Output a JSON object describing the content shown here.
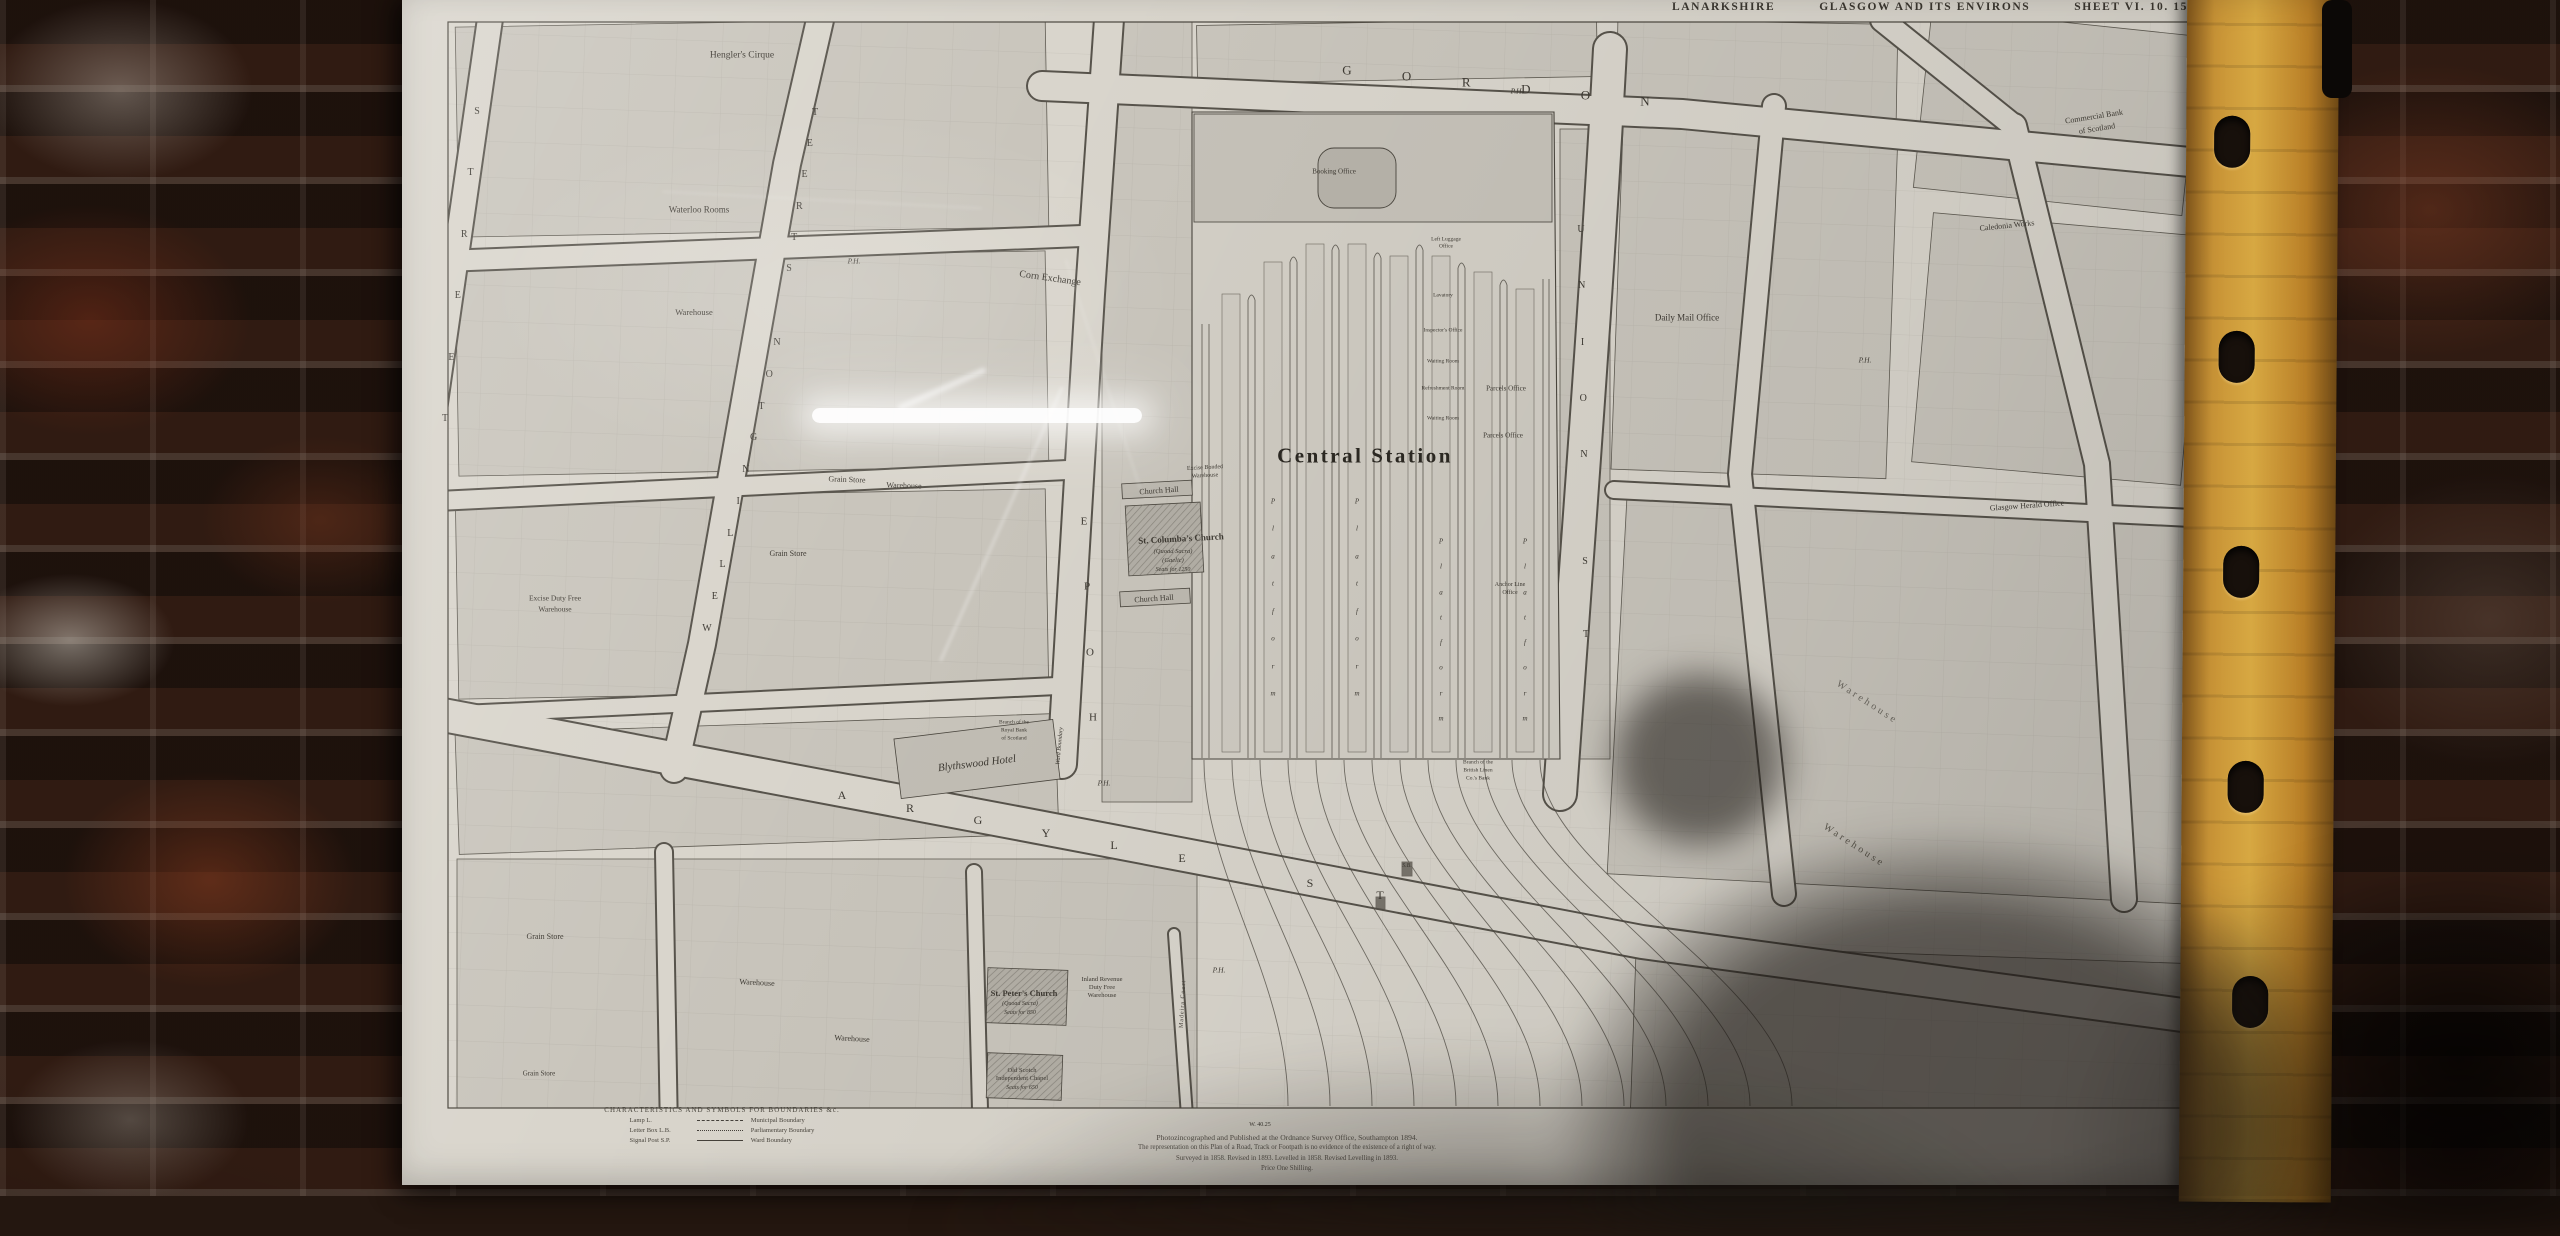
{
  "photo": {
    "colors": {
      "brick_dark": "#2a1911",
      "brick_red": "#7c3f27",
      "mortar": "#b9a99c",
      "binder_strip": "#c08a2e",
      "paper": "#d9d5cc",
      "ink": "#3e3a33"
    },
    "binder_holes": 5
  },
  "map": {
    "header": {
      "county": "LANARKSHIRE",
      "title": "GLASGOW AND ITS ENVIRONS",
      "sheet": "SHEET VI. 10. 15"
    },
    "station_title": "Central Station",
    "labels": [
      {
        "t": "Central Station",
        "x": 963,
        "y": 462,
        "s": 21,
        "b": 1,
        "ls": 2.5,
        "c": "#2c2923"
      },
      {
        "t": "Hengler's Cirque",
        "x": 340,
        "y": 62,
        "s": 9.5
      },
      {
        "t": "Waterloo Rooms",
        "x": 297,
        "y": 216,
        "s": 9
      },
      {
        "t": "Warehouse",
        "x": 292,
        "y": 318,
        "s": 8.5
      },
      {
        "t": "Corn Exchange",
        "x": 648,
        "y": 285,
        "s": 10,
        "r": 8
      },
      {
        "t": "P.H.",
        "x": 452,
        "y": 267,
        "s": 7.5,
        "i": 1
      },
      {
        "t": "P.H.",
        "x": 1115,
        "y": 97,
        "s": 7.5,
        "i": 1
      },
      {
        "t": "P.H.",
        "x": 1463,
        "y": 366,
        "s": 7.5,
        "i": 1
      },
      {
        "t": "P.H.",
        "x": 702,
        "y": 789,
        "s": 7.5,
        "i": 1
      },
      {
        "t": "P.H.",
        "x": 817,
        "y": 976,
        "s": 7.5,
        "i": 1
      },
      {
        "t": "Grain Store",
        "x": 445,
        "y": 486,
        "s": 8,
        "r": 2
      },
      {
        "t": "Warehouse",
        "x": 502,
        "y": 492,
        "s": 8,
        "r": 2
      },
      {
        "t": "Grain Store",
        "x": 386,
        "y": 560,
        "s": 8
      },
      {
        "t": "Excise Duty Free",
        "x": 153,
        "y": 604,
        "s": 7.5
      },
      {
        "t": "Warehouse",
        "x": 153,
        "y": 615,
        "s": 7.5
      },
      {
        "t": "Church Hall",
        "x": 757,
        "y": 497,
        "s": 8,
        "r": -4
      },
      {
        "t": "St. Columba's Church",
        "x": 779,
        "y": 545,
        "s": 9,
        "r": -3,
        "b": 1
      },
      {
        "t": "(Quoad Sacra)",
        "x": 771,
        "y": 558,
        "s": 6.5,
        "i": 1
      },
      {
        "t": "(Gaelic)",
        "x": 771,
        "y": 567,
        "s": 6.5,
        "i": 1
      },
      {
        "t": "Seats for 1250",
        "x": 771,
        "y": 576,
        "s": 6,
        "i": 1
      },
      {
        "t": "Church Hall",
        "x": 752,
        "y": 605,
        "s": 8,
        "r": -4
      },
      {
        "t": "Excise Bonded",
        "x": 803,
        "y": 474,
        "s": 6,
        "r": -3
      },
      {
        "t": "Warehouse",
        "x": 803,
        "y": 482,
        "s": 6,
        "r": -3
      },
      {
        "t": "Blythswood Hotel",
        "x": 575,
        "y": 770,
        "s": 11,
        "i": 1,
        "r": -7
      },
      {
        "t": "Branch of the",
        "x": 612,
        "y": 729,
        "s": 5.5
      },
      {
        "t": "Royal Bank",
        "x": 612,
        "y": 737,
        "s": 5.5
      },
      {
        "t": "of Scotland",
        "x": 612,
        "y": 745,
        "s": 5.5
      },
      {
        "t": "Ward Boundary",
        "x": 658,
        "y": 752,
        "s": 6,
        "i": 1,
        "r": -85
      },
      {
        "t": "Booking Office",
        "x": 932,
        "y": 178,
        "s": 7
      },
      {
        "t": "Left Luggage",
        "x": 1044,
        "y": 246,
        "s": 5.5
      },
      {
        "t": "Office",
        "x": 1044,
        "y": 253,
        "s": 5.5
      },
      {
        "t": "Lavatory",
        "x": 1041,
        "y": 302,
        "s": 5.5
      },
      {
        "t": "Inspector's Office",
        "x": 1041,
        "y": 337,
        "s": 5.5
      },
      {
        "t": "Waiting Room",
        "x": 1041,
        "y": 368,
        "s": 5.5
      },
      {
        "t": "Refreshment Room",
        "x": 1041,
        "y": 395,
        "s": 5.5
      },
      {
        "t": "Waiting Room",
        "x": 1041,
        "y": 425,
        "s": 5.5
      },
      {
        "t": "Parcels Office",
        "x": 1104,
        "y": 395,
        "s": 7
      },
      {
        "t": "Parcels Office",
        "x": 1101,
        "y": 442,
        "s": 7
      },
      {
        "t": "Anchor Line",
        "x": 1108,
        "y": 591,
        "s": 6
      },
      {
        "t": "Office",
        "x": 1108,
        "y": 599,
        "s": 6
      },
      {
        "t": "Branch of the",
        "x": 1076,
        "y": 769,
        "s": 5.5
      },
      {
        "t": "British Linen",
        "x": 1076,
        "y": 777,
        "s": 5.5
      },
      {
        "t": "Co.'s Bank",
        "x": 1076,
        "y": 785,
        "s": 5.5
      },
      {
        "t": "S.B.",
        "x": 1005,
        "y": 872,
        "s": 6,
        "i": 1
      },
      {
        "t": "Daily Mail Office",
        "x": 1285,
        "y": 324,
        "s": 9
      },
      {
        "t": "Caledonia Works",
        "x": 1605,
        "y": 232,
        "s": 8,
        "r": -6
      },
      {
        "t": "Glasgow Herald Office",
        "x": 1625,
        "y": 512,
        "s": 8,
        "r": -4
      },
      {
        "t": "Commercial Bank",
        "x": 1692,
        "y": 123,
        "s": 8,
        "r": -9
      },
      {
        "t": "of Scotland",
        "x": 1695,
        "y": 135,
        "s": 8,
        "r": -9
      },
      {
        "t": "Warehouse",
        "x": 1465,
        "y": 709,
        "s": 10,
        "r": 33,
        "c": "#6b675f",
        "ls": 3
      },
      {
        "t": "Warehouse",
        "x": 1452,
        "y": 852,
        "s": 10,
        "r": 33,
        "c": "#5d594f",
        "ls": 3
      },
      {
        "t": "St. Peter's Church",
        "x": 622,
        "y": 999,
        "s": 8.5,
        "b": 1
      },
      {
        "t": "(Quoad Sacra)",
        "x": 618,
        "y": 1010,
        "s": 6,
        "i": 1
      },
      {
        "t": "Seats for 850",
        "x": 618,
        "y": 1019,
        "s": 6,
        "i": 1
      },
      {
        "t": "Inland Revenue",
        "x": 700,
        "y": 986,
        "s": 6.5
      },
      {
        "t": "Duty Free",
        "x": 700,
        "y": 994,
        "s": 6.5
      },
      {
        "t": "Warehouse",
        "x": 700,
        "y": 1002,
        "s": 6.5
      },
      {
        "t": "Madeira Court",
        "x": 781,
        "y": 1010,
        "s": 6,
        "r": -87,
        "ls": 1
      },
      {
        "t": "Old Scotch",
        "x": 620,
        "y": 1077,
        "s": 6.5
      },
      {
        "t": "Independent Chapel",
        "x": 620,
        "y": 1085,
        "s": 6.5
      },
      {
        "t": "Seats for 650",
        "x": 620,
        "y": 1094,
        "s": 6,
        "i": 1
      },
      {
        "t": "Grain Store",
        "x": 143,
        "y": 943,
        "s": 8
      },
      {
        "t": "Warehouse",
        "x": 355,
        "y": 989,
        "s": 8,
        "r": 3
      },
      {
        "t": "Warehouse",
        "x": 450,
        "y": 1045,
        "s": 8,
        "r": 3
      },
      {
        "t": "Grain Store",
        "x": 137,
        "y": 1080,
        "s": 7
      },
      {
        "t": "W. 40.25",
        "x": 858,
        "y": 1131,
        "s": 6
      }
    ],
    "street_words": [
      {
        "w": "GORDON",
        "x1": 945,
        "y1": 76,
        "x2": 1243,
        "y2": 107,
        "s": 13
      },
      {
        "w": "WELLINGTON",
        "x1": 305,
        "y1": 635,
        "x2": 375,
        "y2": 349,
        "s": 10
      },
      {
        "w": "STREET",
        "x1": 387,
        "y1": 275,
        "x2": 413,
        "y2": 119,
        "s": 10
      },
      {
        "w": "HOPE",
        "x1": 691,
        "y1": 724,
        "x2": 682,
        "y2": 528,
        "s": 11
      },
      {
        "w": "UNION",
        "x1": 1179,
        "y1": 236,
        "x2": 1182,
        "y2": 461,
        "s": 10
      },
      {
        "w": "ST",
        "x1": 1183,
        "y1": 568,
        "x2": 1184,
        "y2": 641,
        "s": 10
      },
      {
        "w": "ARGYLE",
        "x1": 440,
        "y1": 801,
        "x2": 780,
        "y2": 864,
        "s": 12
      },
      {
        "w": "ST",
        "x1": 908,
        "y1": 889,
        "x2": 978,
        "y2": 901,
        "s": 12
      },
      {
        "w": "STREET",
        "x1": 75,
        "y1": 118,
        "x2": 43,
        "y2": 425,
        "s": 10
      },
      {
        "w": "Platform",
        "x1": 871,
        "y1": 508,
        "x2": 871,
        "y2": 700,
        "s": 7,
        "i": 1
      },
      {
        "w": "Platform",
        "x1": 955,
        "y1": 508,
        "x2": 955,
        "y2": 700,
        "s": 7,
        "i": 1
      },
      {
        "w": "Platform",
        "x1": 1039,
        "y1": 548,
        "x2": 1039,
        "y2": 725,
        "s": 7,
        "i": 1
      },
      {
        "w": "Platform",
        "x1": 1123,
        "y1": 548,
        "x2": 1123,
        "y2": 725,
        "s": 7,
        "i": 1
      }
    ],
    "legend": {
      "heading": "CHARACTERISTICS AND SYMBOLS FOR BOUNDARIES &c.",
      "symbols": [
        {
          "label": "Lamp  L."
        },
        {
          "label": "Letter Box  L.B."
        },
        {
          "label": "Signal Post  S.P."
        }
      ],
      "boundaries": [
        {
          "label": "Municipal Boundary",
          "style": "dashed"
        },
        {
          "label": "Parliamentary Boundary",
          "style": "dotted"
        },
        {
          "label": "Ward Boundary",
          "style": "solid"
        }
      ]
    },
    "imprint": {
      "lines": [
        "Photozincographed and Published at the Ordnance Survey Office, Southampton 1894.",
        "The representation on this Plan of a Road, Track or Footpath is no evidence of the existence of a right of way.",
        "Surveyed in 1858. Revised in 1893. Levelled in 1858. Revised Levelling in 1893.",
        "Price One Shilling."
      ]
    }
  }
}
